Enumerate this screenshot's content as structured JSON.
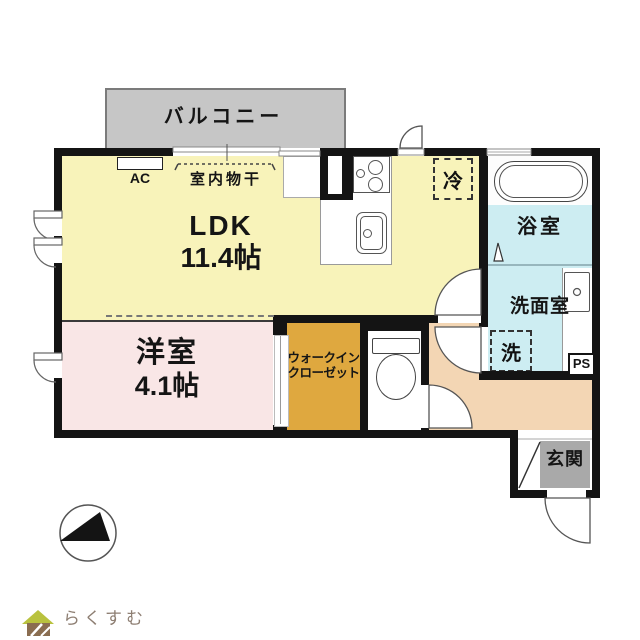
{
  "title": "floor-plan",
  "labels": {
    "balcony": "バルコニー",
    "ac": "AC",
    "indoor_drying": "室内物干",
    "ldk_name": "LDK",
    "ldk_size": "11.4帖",
    "fridge": "冷",
    "bathroom": "浴室",
    "washroom": "洗面室",
    "washer": "洗",
    "pipe_space": "PS",
    "western_room_name": "洋室",
    "western_room_size": "4.1帖",
    "wic_line1": "ウォークイン",
    "wic_line2": "クローゼット",
    "entrance": "玄関",
    "logo": "らくすむ"
  },
  "icons": {
    "compass": "north-arrow-compass-icon",
    "logo_house": "house-logo-icon",
    "stove": "two-burner-stove-icon",
    "sink": "kitchen-sink-icon",
    "bathtub": "bathtub-icon",
    "toilet": "toilet-icon",
    "vanity": "washbasin-icon"
  },
  "colors": {
    "wall": "#141414",
    "ldk": "#f8f3ba",
    "western_room": "#f9e6e6",
    "wic": "#dfa83f",
    "wet": "#cdedf2",
    "hallway": "#f3d6b4",
    "entrance_floor": "#a9a9a9",
    "balcony": "#c6c6c6",
    "logo_text": "#8d7e72",
    "logo_roof": "#b9c23e",
    "logo_body": "#8a6d50"
  }
}
